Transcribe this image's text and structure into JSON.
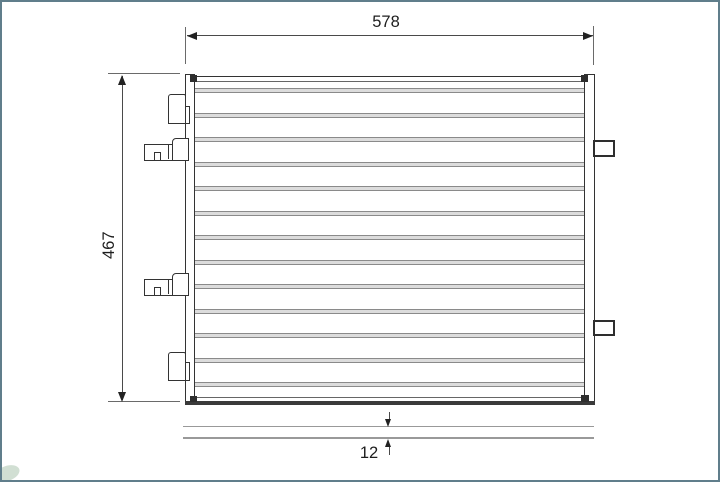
{
  "frame": {
    "background": "#ffffff",
    "border_color": "#607e8b"
  },
  "diagram": {
    "kind": "technical-part-drawing",
    "subject": "condenser-radiator-front-view-with-thickness-profile",
    "dim_width": "578",
    "dim_height": "467",
    "dim_depth": "12",
    "tube_count": 13,
    "left_fitting_count": 4,
    "right_bracket_count": 2,
    "colors": {
      "outline": "#333333",
      "dimension_line": "#4a4a4a",
      "tube_edge": "#8a8a8a",
      "tube_fill": "#dcdcdc",
      "side_profile_line": "#999999",
      "arrow": "#222222"
    }
  }
}
